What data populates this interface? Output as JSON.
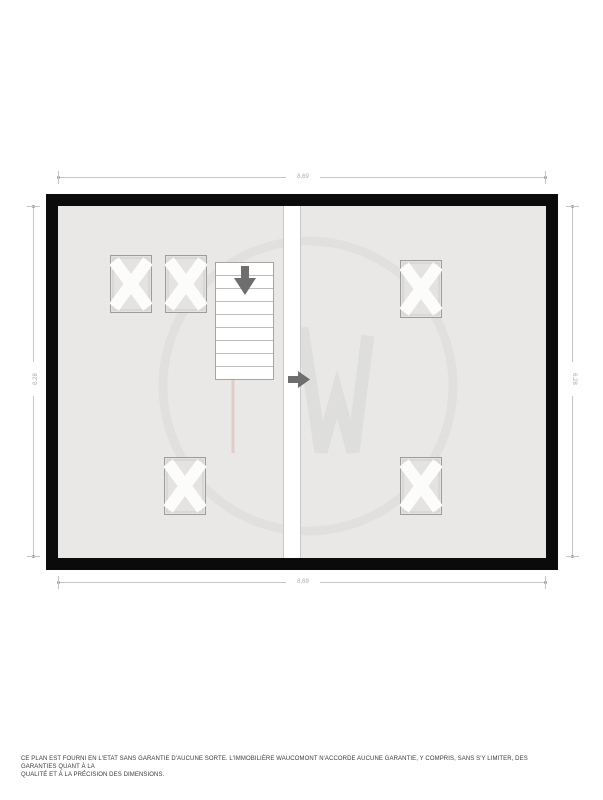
{
  "room": {
    "name": "Grenier",
    "details": "54.57 m² (8.69 × 6.28)"
  },
  "dimensions": {
    "width_top": "8.69",
    "width_bottom": "8.69",
    "height_left": "6.28",
    "height_right": "6.28"
  },
  "footer": {
    "line1": "CE PLAN EST FOURNI EN L'ETAT SANS GARANTIE D'AUCUNE SORTE. L'IMMOBILIÈRE WAUCOMONT N'ACCORDE AUCUNE GARANTIE, Y COMPRIS, SANS S'Y LIMITER, DES GARANTIES QUANT À LA",
    "line2": "QUALITÉ ET À LA PRÉCISION DES DIMENSIONS."
  },
  "icons": {
    "stairs_direction": "down-arrow",
    "entry_direction": "right-arrow",
    "skylight_mark": "x-cross-window",
    "watermark": "w-monogram-circle"
  },
  "colors": {
    "wall": "#0b0b0b",
    "floor": "#e9e8e6",
    "divider": "#ffffff",
    "arrow": "#6e6e6e",
    "dimension": "#adaba9",
    "room_text": "#3f3f3f",
    "footer_text": "#3a3a3a",
    "watermark_pink": "#dba49b"
  }
}
